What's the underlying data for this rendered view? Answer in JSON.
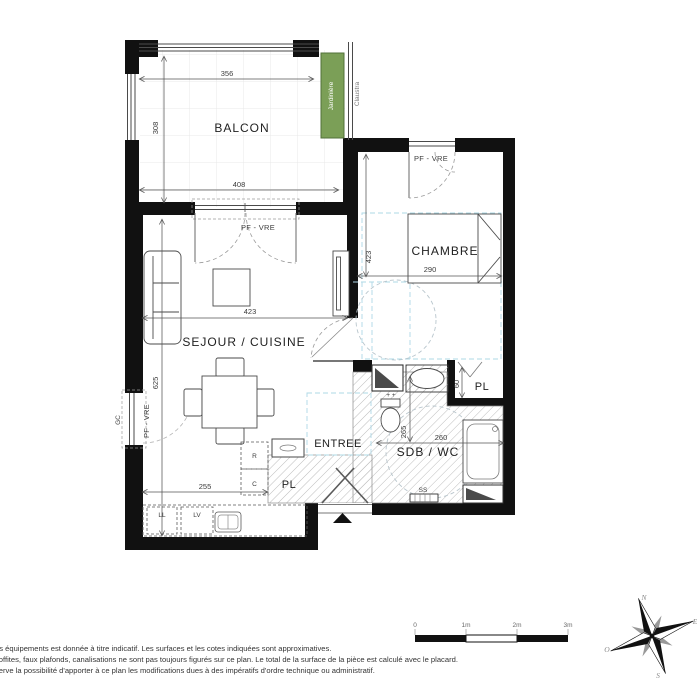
{
  "plan": {
    "rooms": {
      "balcon": "BALCON",
      "chambre": "CHAMBRE",
      "sejour": "SEJOUR / CUISINE",
      "entree": "ENTREE",
      "sdb": "SDB / WC",
      "pl_bain": "PL",
      "pl_entree": "PL"
    },
    "annotations": {
      "pf_vre": "PF - VRE",
      "gc": "GC",
      "jardiniere": "Jardinière",
      "claustra": "Claustra",
      "ll": "LL",
      "lv": "LV",
      "r": "R",
      "c": "C",
      "ss": "SS",
      "taps": "+ +"
    },
    "dims": {
      "balcon_width_top": "356",
      "balcon_depth": "308",
      "balcon_width_bottom": "408",
      "sejour_width": "423",
      "sejour_depth": "625",
      "chambre_depth": "423",
      "chambre_width": "290",
      "sdb_depth": "265",
      "sdb_width": "260",
      "pl_depth": "60",
      "cuisine_width": "255"
    }
  },
  "scalebar": {
    "ticks": [
      "0",
      "1m",
      "2m",
      "3m"
    ]
  },
  "compass": {
    "north": "N",
    "east": "E",
    "south": "S",
    "west": "O"
  },
  "footer": {
    "line1": "es équipements est donnée à titre indicatif. Les surfaces et les cotes indiquées sont approximatives.",
    "line2": "soffites, faux plafonds, canalisations ne sont pas toujours figurés sur ce plan. Le total de la surface de la pièce est calculé avec le placard.",
    "line3": "serve la possibilité d'apporter à ce plan les modifications dues à des impératifs d'ordre technique ou administratif."
  },
  "colors": {
    "wall": "#111111",
    "line": "#4a4a4a",
    "hatch": "#bdbdbd",
    "cyan_dash": "#aed8e6",
    "circle_dash": "#b9c6cd",
    "jardiniere_green": "#7b9f57",
    "jardiniere_border": "#52703a"
  }
}
